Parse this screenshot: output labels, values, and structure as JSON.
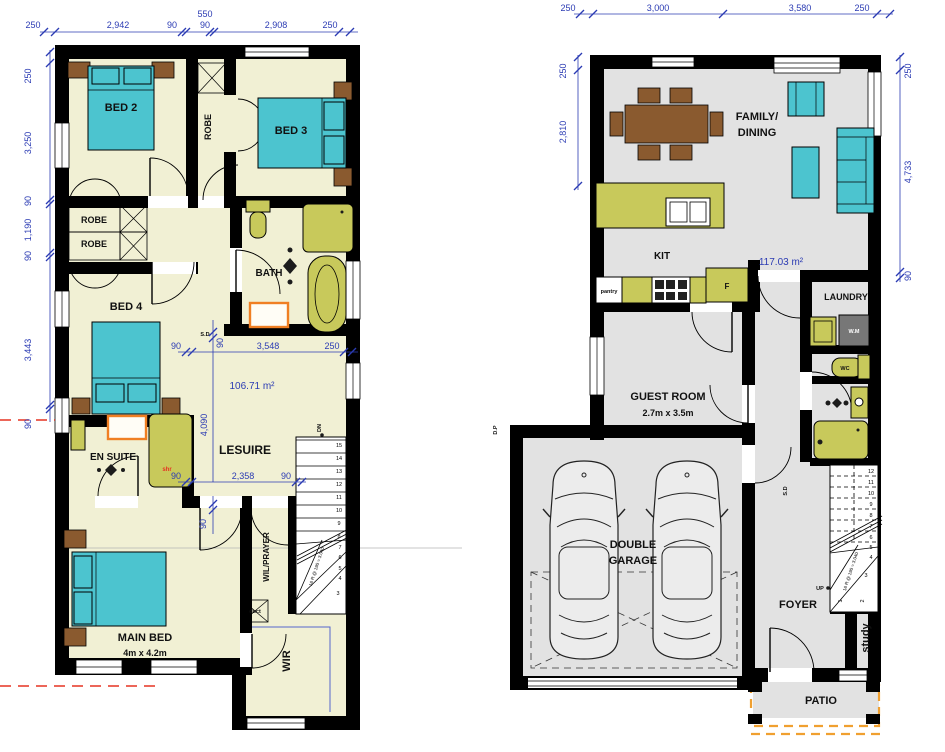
{
  "colors": {
    "wall": "#000000",
    "floor_upper": "#f1f0d4",
    "floor_ground": "#e2e2e2",
    "teal": "#4cc4cf",
    "olive": "#c8c95b",
    "brown": "#8a5a2f",
    "orange_vanity": "#f07f23",
    "orange_dash": "#f0a030",
    "dim_blue": "#2b3bb3",
    "red": "#e63322"
  },
  "upper": {
    "rooms": {
      "bed2": "BED 2",
      "bed3": "BED 3",
      "robe_vert": "ROBE",
      "robe_a": "ROBE",
      "robe_b": "ROBE",
      "bath": "BATH",
      "bed4": "BED 4",
      "ensuite": "EN SUITE",
      "shr": "shr",
      "leisure": "LESUIRE",
      "area": "106.71 m²",
      "main_bed": "MAIN BED",
      "main_bed_size": "4m x 4.2m",
      "wil_prayer": "WIL/PRAYER",
      "duct": "duct",
      "wir": "WIR"
    },
    "stairs": {
      "dn": "DN",
      "note": "16 R @ 190 = 3.040",
      "numbers": [
        "15",
        "14",
        "13",
        "12",
        "11",
        "10",
        "9",
        "8",
        "7",
        "6",
        "5",
        "4",
        "3"
      ]
    },
    "dims": {
      "top": [
        "250",
        "2,942",
        "90",
        "550",
        "90",
        "2,908",
        "250"
      ],
      "left": [
        "250",
        "3,250",
        "90",
        "1,190",
        "90",
        "3,443",
        "90"
      ],
      "row_a": [
        "90",
        "3,548",
        "250"
      ],
      "row_b": [
        "90",
        "2,358",
        "90"
      ],
      "v_span": "4,090",
      "v_wall_a": "90",
      "v_wall_b": "90",
      "sd": "S.D"
    }
  },
  "ground": {
    "rooms": {
      "family_1": "FAMILY/",
      "family_2": "DINING",
      "kit": "KIT",
      "area": "117.03 m²",
      "pantry": "pantry",
      "fridge": "F",
      "laundry": "LAUNDRY",
      "wm": "W.M",
      "wc": "WC",
      "guest": "GUEST ROOM",
      "guest_size": "2.7m x  3.5m",
      "garage_1": "DOUBLE",
      "garage_2": "GARAGE",
      "foyer": "FOYER",
      "study": "study",
      "patio": "PATIO",
      "dp": "D.P",
      "sd": "S.D"
    },
    "stairs": {
      "up": "UP",
      "note": "16 R @ 190 = 3.040",
      "numbers": [
        "12",
        "11",
        "10",
        "9",
        "8",
        "7",
        "6",
        "5",
        "4",
        "3",
        "2",
        "1"
      ]
    },
    "dims": {
      "top": [
        "250",
        "3,000",
        "3,580",
        "250"
      ],
      "left": [
        "250",
        "2,810"
      ],
      "right": [
        "250",
        "4,733",
        "90"
      ]
    }
  }
}
